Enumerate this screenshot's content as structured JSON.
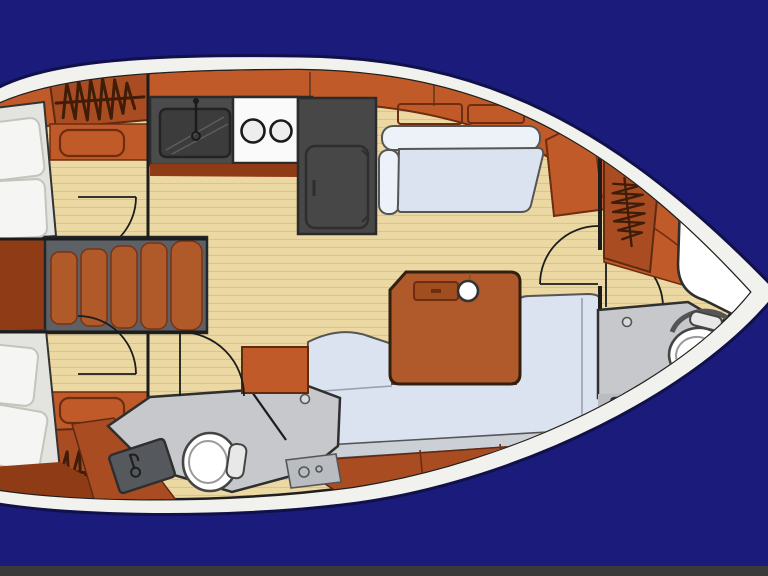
{
  "scene": {
    "type": "sailboat-interior-floor-plan",
    "orientation": "bow-right-stern-left",
    "background": "navy-water",
    "visible_text": "none"
  },
  "colors": {
    "navy": "#1b1b7c",
    "hullWhite": "#f1f1ee",
    "woodDark": "#a94c22",
    "woodBright": "#c05a28",
    "woodDeep": "#8f3c16",
    "tread": "#b05a2a",
    "stepWell": "#5d6166",
    "floor": "#ecd8a2",
    "floorLine": "#dcc28b",
    "counter": "#4b4b4b",
    "counterDark": "#3c3c3c",
    "stove": "#fafafa",
    "fridge": "#474747",
    "cushionWhite": "#f5f5f3",
    "cushionBase": "#e3e3df",
    "cushionBlue": "#dce3f0",
    "cushionBlueHi": "#edf1f8",
    "seatBack": "#cbd0d6",
    "headFloor": "#c6c8cb",
    "headFloorLight": "#b9bcc0",
    "fixtureGray": "#55585c",
    "tableWood": "#b0592a",
    "white": "#ffffff",
    "glyph": "#3f1d08",
    "bottomBar": "#3a3a3a"
  },
  "areas": {
    "hull": "Yacht hull",
    "aftCabinPort": "Aft cabin port with double berth",
    "aftCabinStarboard": "Aft cabin starboard with double berth",
    "companionway": "Companionway steps",
    "galley": "Galley with sink, stove and refrigerator",
    "aftHead": "Aft head with toilet and washbasin",
    "salon": "Salon with settees and table",
    "forwardCabin": "Forward cabin with berth",
    "forwardHead": "Forward head with toilet and washbasin"
  },
  "fixtures": {
    "hangingLockerSymbolCount": 3,
    "toiletCount": 2,
    "washbasinCount": 2,
    "stoveBurners": 2,
    "companionwaySteps": 5,
    "mastPost": 1,
    "doorSwingArcs": 6
  }
}
